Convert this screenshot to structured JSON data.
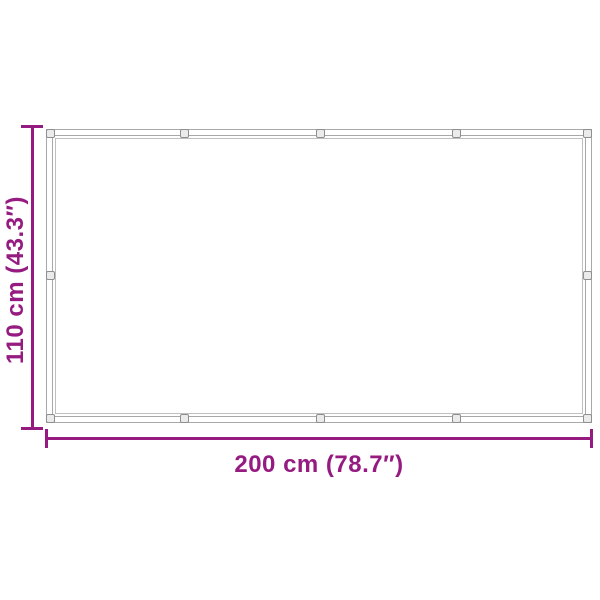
{
  "diagram": {
    "type": "product-dimension-diagram",
    "subject": "rectangular tarp with reinforced hem and grommets",
    "width_label": "200 cm (78.7″)",
    "height_label": "110 cm (43.3″)",
    "grommet_count": 12,
    "colors": {
      "dimension": "#951b81",
      "frame_line": "#a8a8a8",
      "stitch_line": "#bfbfbf",
      "grommet_border": "#8f8f8f",
      "grommet_fill": "#ebebeb",
      "background": "#ffffff"
    }
  }
}
